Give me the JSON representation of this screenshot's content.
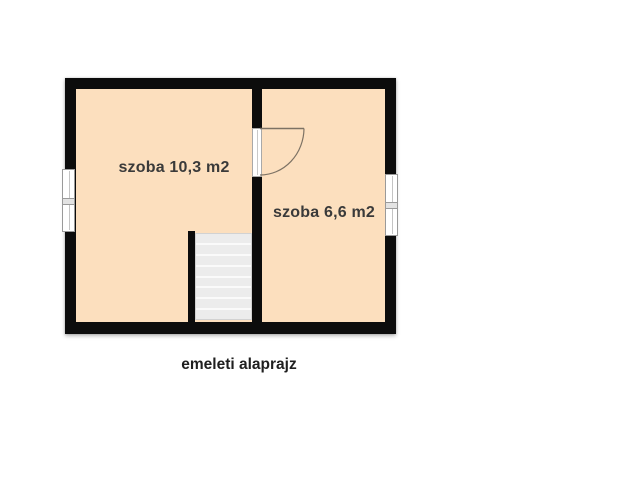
{
  "page": {
    "background_color": "#ffffff"
  },
  "floorplan": {
    "caption": "emeleti alaprajz",
    "colors": {
      "wall": "#0c0c0c",
      "floor": "#fcdfbe",
      "stair_fill": "#ececec",
      "stair_line": "#fafafa",
      "window_frame_line": "#9a9a9a",
      "door_line": "#7d7264",
      "room_label_text": "#3a3a3a",
      "caption_text": "#1f1f1f"
    },
    "rooms": [
      {
        "label": "szoba 10,3 m2"
      },
      {
        "label": "szoba 6,6 m2"
      }
    ],
    "stairs": {
      "steps": 8
    },
    "windows": [
      {
        "side": "left",
        "panes": 2
      },
      {
        "side": "right",
        "panes": 2
      }
    ],
    "door": {
      "style": "quarter-circle swing into right room"
    }
  }
}
